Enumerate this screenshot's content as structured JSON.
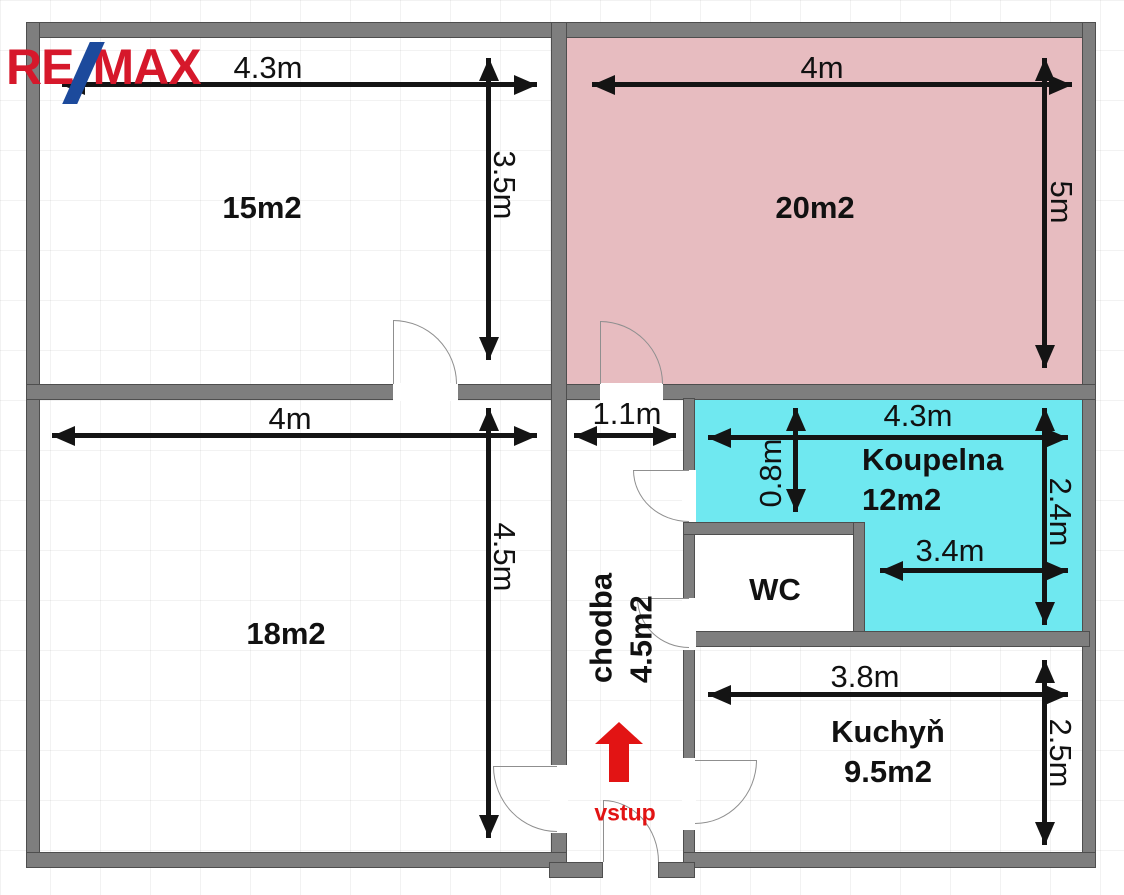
{
  "logo": {
    "re": "RE",
    "slash": "/",
    "max": "MAX",
    "red": "#d6182b",
    "blue": "#1c4a9c"
  },
  "colors": {
    "wall": "#7e7e7e",
    "room20_fill": "#e7bcc0",
    "koupelna_fill": "#6fe8f0",
    "arrow_black": "#141414",
    "entrance_red": "#e21414"
  },
  "rooms": {
    "r15": {
      "area": "15m2",
      "w": "4.3m",
      "h": "3.5m"
    },
    "r20": {
      "area": "20m2",
      "w": "4m",
      "h": "5m"
    },
    "r18": {
      "area": "18m2",
      "w": "4m",
      "h": "4.5m"
    },
    "chodba": {
      "name": "chodba",
      "area": "4.5m2",
      "w": "1.1m"
    },
    "koupelna": {
      "name": "Koupelna",
      "area": "12m2",
      "w": "4.3m",
      "h": "2.4m",
      "w_inner": "3.4m",
      "h_niche": "0.8m"
    },
    "wc": {
      "name": "WC"
    },
    "kuchyn": {
      "name": "Kuchyň",
      "area": "9.5m2",
      "w": "3.8m",
      "h": "2.5m"
    },
    "entrance": {
      "label": "vstup"
    }
  }
}
